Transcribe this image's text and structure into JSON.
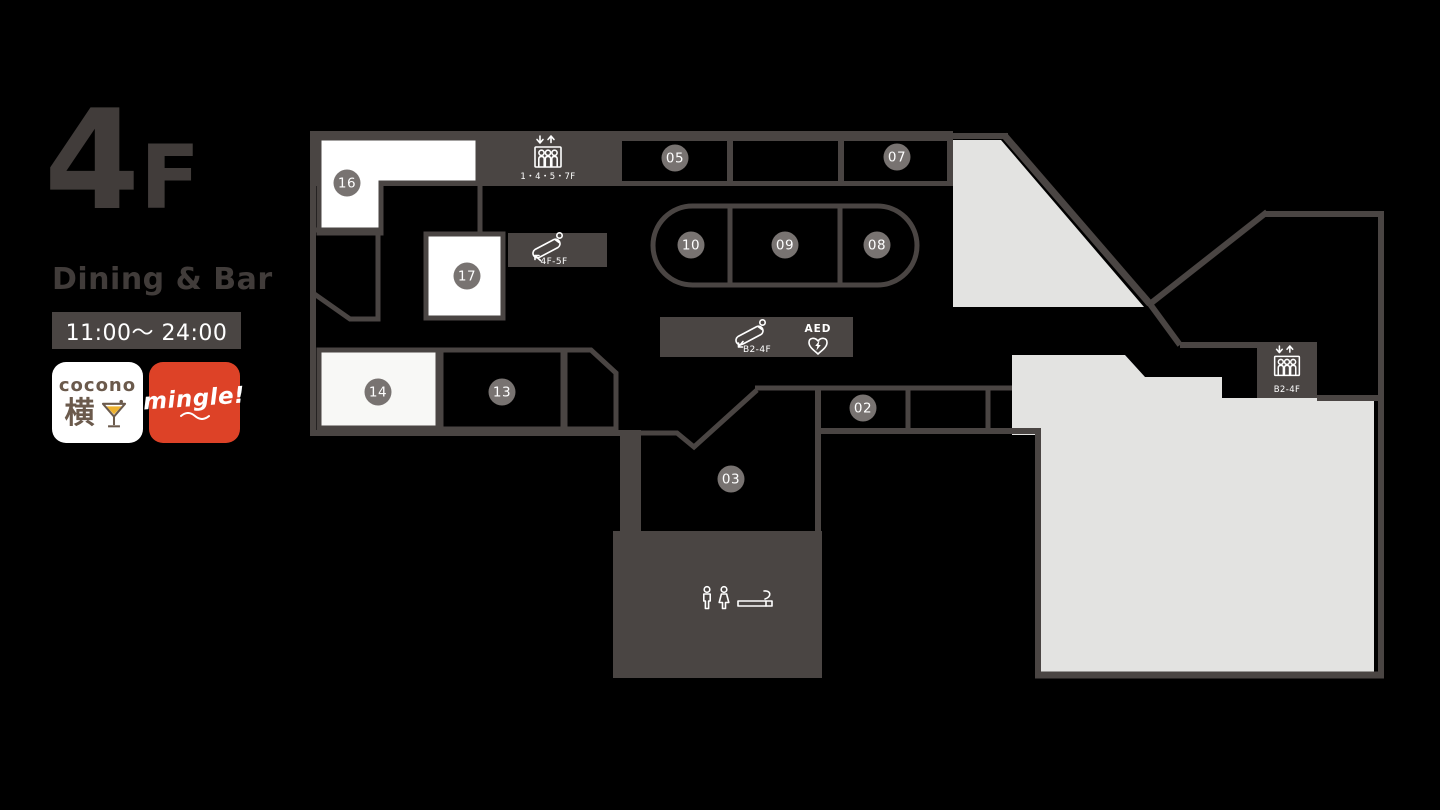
{
  "colors": {
    "background": "#000000",
    "wall": "#4a4543",
    "room": "#000000",
    "badge": "#787371",
    "badge-text": "#ffffff",
    "unit-white": "#ffffff",
    "unit-offwhite": "#f8f8f6",
    "zone-gray": "#e3e3e1",
    "icon": "#ffffff",
    "title": "#413c3a",
    "hours-bg": "#4a4543",
    "hours-text": "#ffffff",
    "cocono-brown": "#6b5a4c",
    "cocono-yellow": "#eeb22e",
    "mingle-red": "#dd4227",
    "logo-bg": "#ffffff"
  },
  "panel": {
    "floor_number": "4",
    "floor_suffix": "F",
    "category": "Dining & Bar",
    "hours": "11:00〜 24:00",
    "cocono": {
      "wordmark": "cocono",
      "kanji": "横"
    },
    "mingle": {
      "wordmark": "mingle!"
    }
  },
  "map": {
    "units": [
      {
        "label": "16"
      },
      {
        "label": "17"
      },
      {
        "label": "14"
      },
      {
        "label": "13"
      },
      {
        "label": "05"
      },
      {
        "label": "07"
      },
      {
        "label": "10"
      },
      {
        "label": "09"
      },
      {
        "label": "08"
      },
      {
        "label": "02"
      },
      {
        "label": "03"
      }
    ],
    "facilities": {
      "elevator_upper": "1・4・5・7F",
      "escalator_upper": "4F-5F",
      "escalator_lower": "B2-4F",
      "aed": "AED",
      "elevator_right": "B2-4F"
    }
  }
}
